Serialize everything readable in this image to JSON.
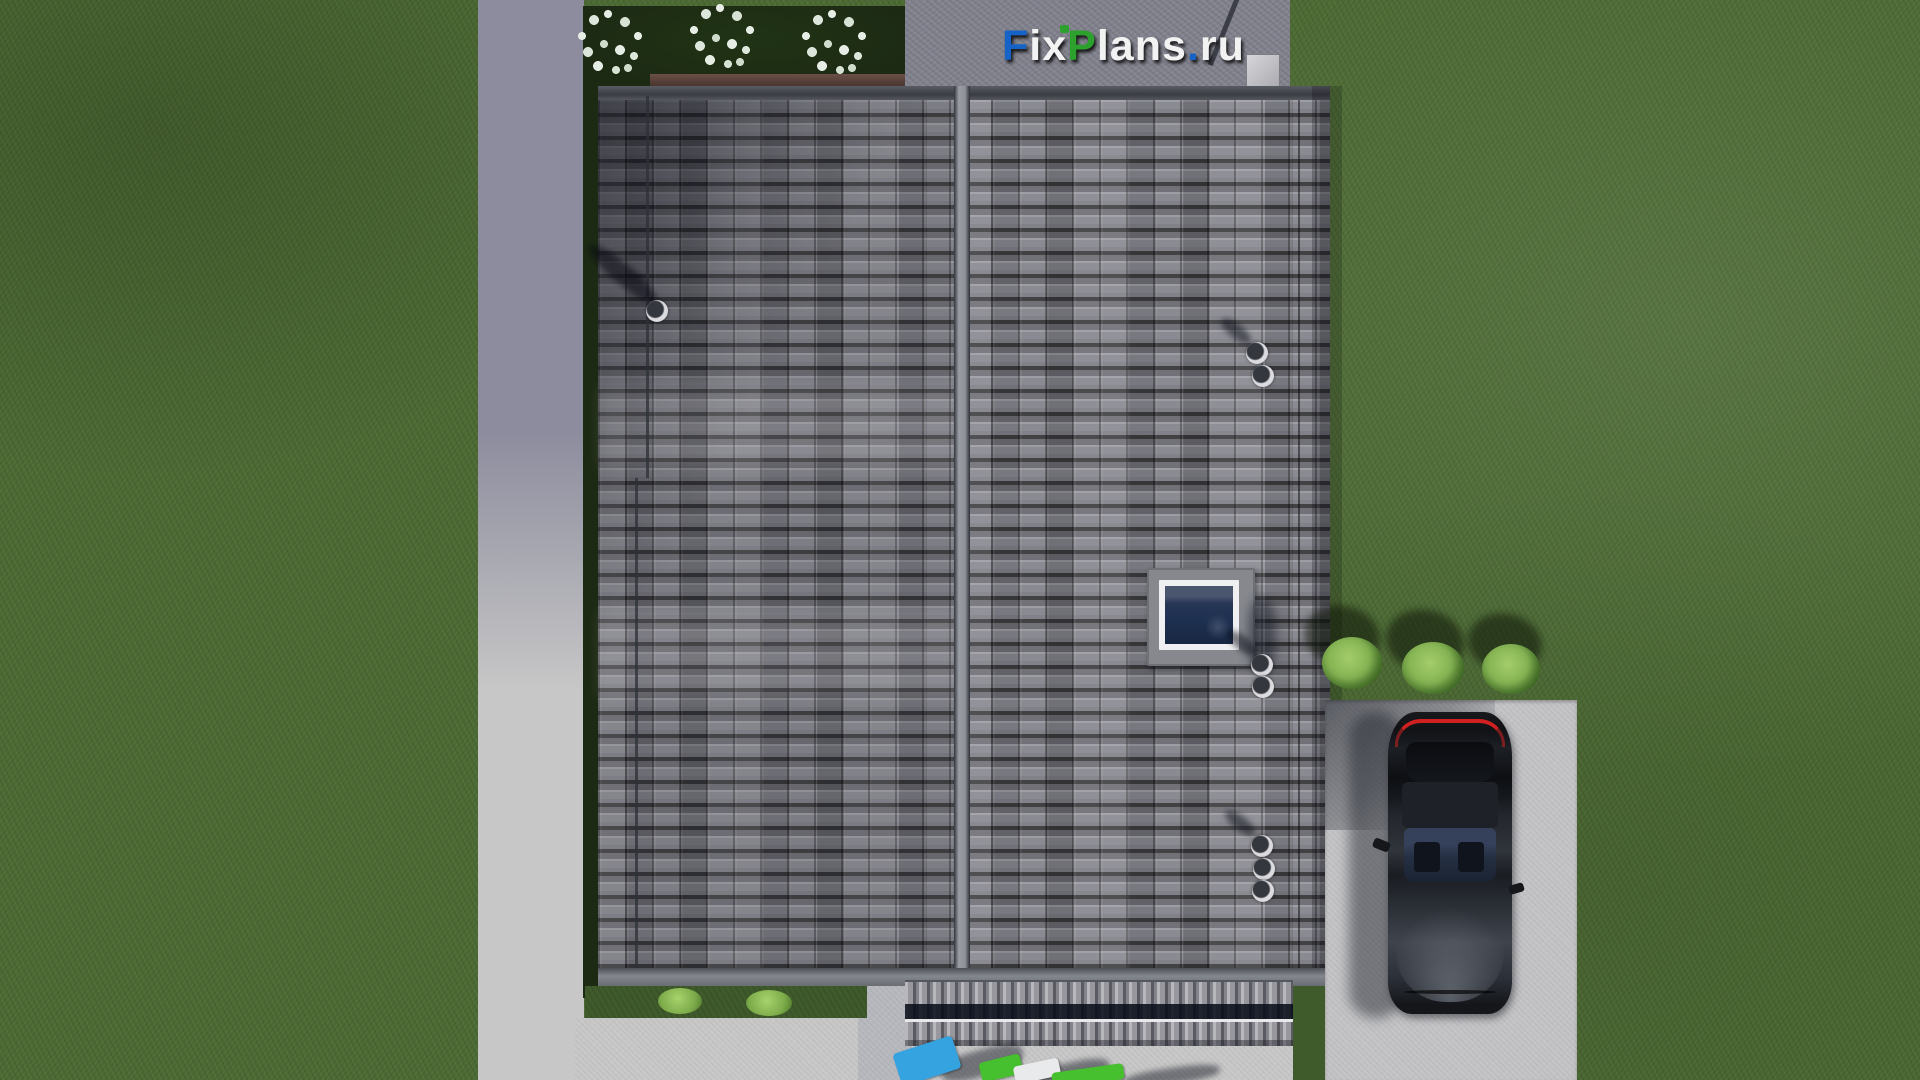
{
  "watermark": {
    "text": "FixPlans.ru",
    "parts": [
      "F",
      "ix",
      "P",
      "lans",
      ".",
      "ru"
    ]
  },
  "scene": {
    "view": "top-down aerial 3D render",
    "objects": {
      "roof": "gray tiled gable roof with central vertical ridge",
      "skylight": "roof window, white frame, dark blue glass",
      "roof_vents": "8 round vent pipes",
      "flower_bed": "dark planter with 3 white flowering shrubs",
      "pergola": "slatted terrace canopy at lower roof edge",
      "driveway": "L-shaped concrete path",
      "parking_pad": "concrete pad with dark sedan, top view",
      "bushes": "3 round green bushes",
      "loungers": "blue, green and white loungers at bottom edge",
      "lawn": "green grass"
    }
  },
  "colors": {
    "grass": "#4c6a33",
    "grass-dark": "#3f5a2b",
    "path-shadow": "#8c8c9e",
    "path-light": "#c7c7c7",
    "concrete-pad": "#c3c3c5",
    "bed": "#1c2913",
    "roof-tile": "#84848c",
    "ridge": "#94969e",
    "sky-glass": "#1e3050",
    "taillight": "#d02020",
    "bush": "#86b554",
    "logo-blue": "#1663c7",
    "logo-green": "#2da12d",
    "logo-white": "#f2f2f2"
  }
}
